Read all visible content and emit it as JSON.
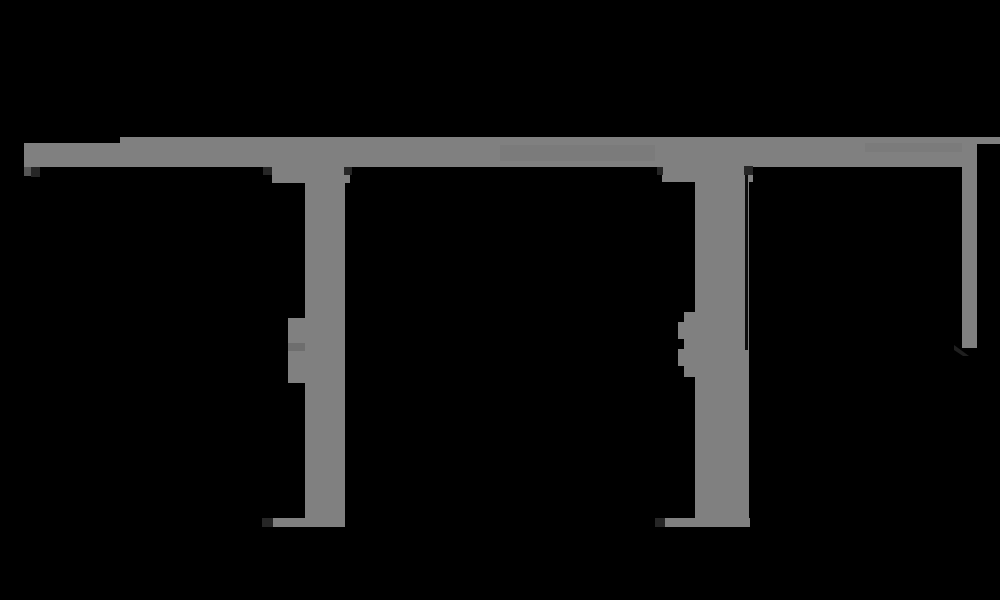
{
  "meta": {
    "width_px": 1000,
    "height_px": 600,
    "kind": "dark UI screenshot with transparent background rendered black",
    "visible_text": "none legible; title and caption lines are merged solid black blobs invisible on the black background"
  },
  "colors": {
    "background": "#000000",
    "frame_gray": "#808080",
    "frame_gray_dim": "#7b7b7b",
    "handle_seam": "#6e6e6e",
    "corner_mark_dark": "#262626",
    "corner_mark_mid": "#565656",
    "panel_black": "#000000",
    "overlay_line": "#0d0d0d",
    "cursor_dark": "#1f1f1f",
    "redacted_black": "#000000"
  },
  "header": {
    "title_label": "illegible black text blob",
    "subtitle_label": "illegible black text blob",
    "caption_rule_label": "illegible thin black text line"
  },
  "toolbar": {
    "label": "gray toolbar band",
    "segments": [
      "left-segment",
      "main-segment",
      "right-tail"
    ],
    "smudges": [
      "illegible darker label smudge left",
      "illegible darker label smudge right"
    ]
  },
  "panels": [
    {
      "id": "panel-1",
      "label": "black content panel 1"
    },
    {
      "id": "panel-2",
      "label": "black content panel 2"
    },
    {
      "id": "panel-3",
      "label": "black content panel 3 (extends to right edge below scrollbar)"
    }
  ],
  "splitters": [
    {
      "id": "splitter-1",
      "label": "vertical splitter gutter with grip handle",
      "parts": [
        "head",
        "stem",
        "grip-handle",
        "foot",
        "corner-marks"
      ]
    },
    {
      "id": "splitter-2",
      "label": "vertical splitter gutter with jagged grip handle and thin dark line",
      "parts": [
        "head",
        "stem",
        "grip-handle",
        "teeth",
        "foot",
        "corner-marks",
        "overlay-line"
      ]
    }
  ],
  "scrollbar": {
    "orientation": "vertical",
    "label": "right scrollbar thumb, upper half of content area"
  },
  "cursor": {
    "icon": "cursor-arrow-icon",
    "label": "small dark pointer wedge at scrollbar lower end"
  },
  "icons": {
    "panel_corner_glyph": "tiny two-tone dark glyph at panel-1 top-left corner"
  }
}
